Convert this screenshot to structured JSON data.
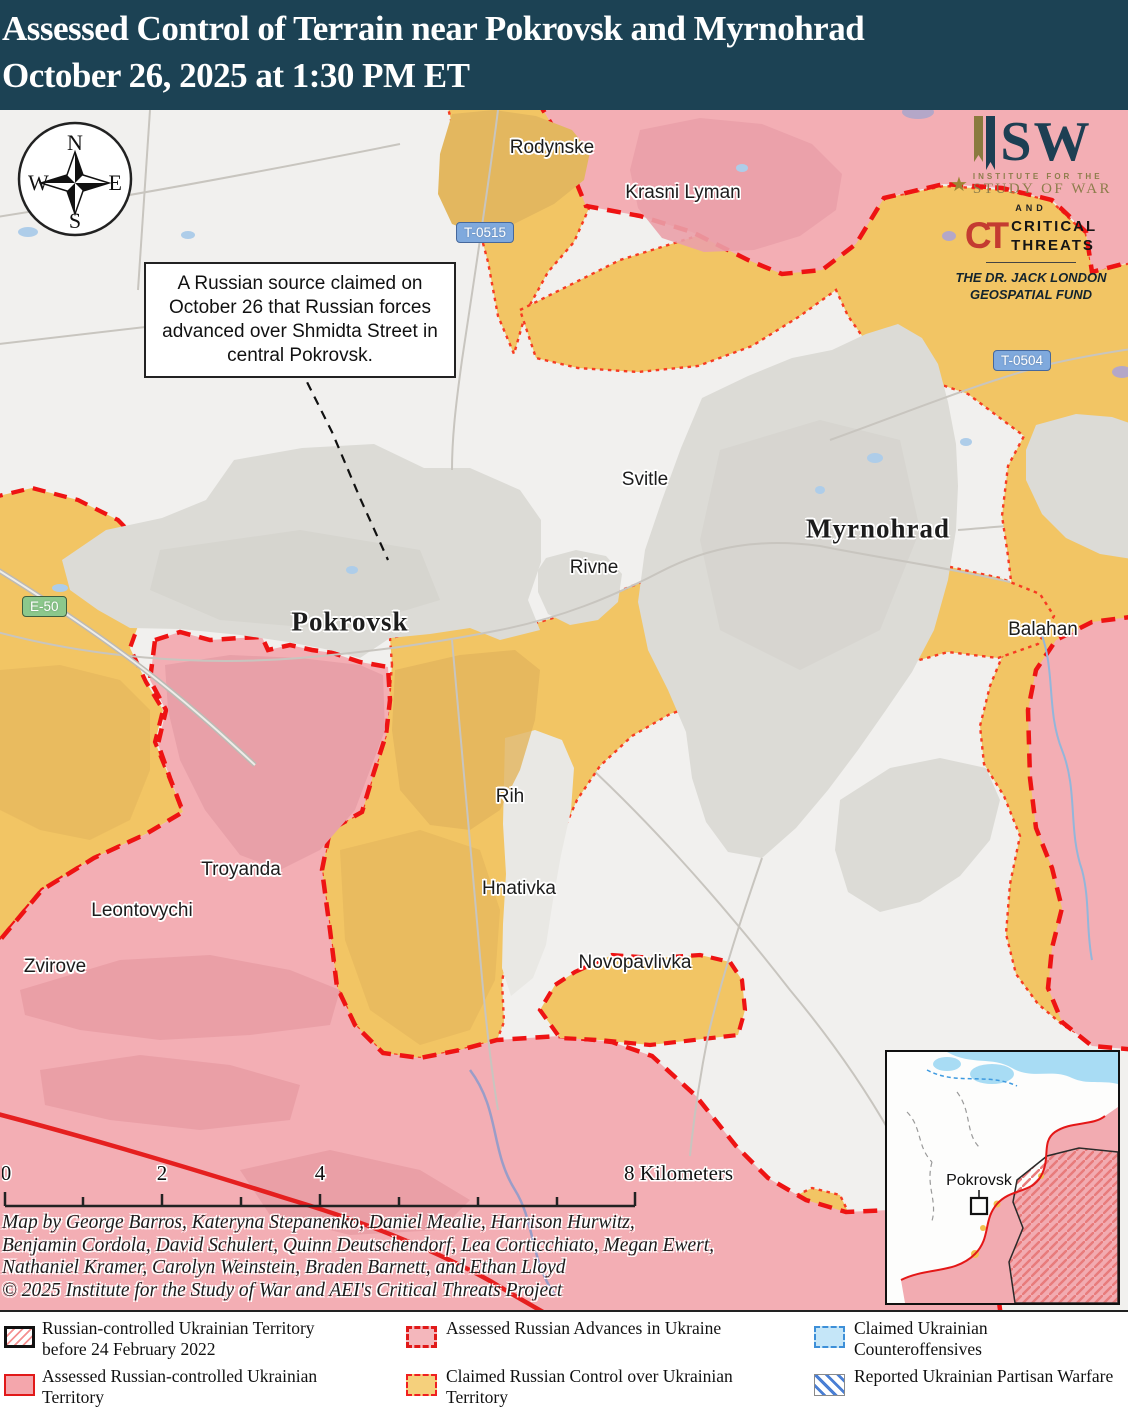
{
  "header": {
    "line1": "Assessed Control of Terrain near Pokrovsk and Myrnohrad",
    "line2": "October 26, 2025 at 1:30 PM ET"
  },
  "compass": {
    "n": "N",
    "e": "E",
    "s": "S",
    "w": "W"
  },
  "callout": {
    "text": "A Russian source claimed on October 26 that Russian forces advanced over Shmidta Street in central Pokrovsk."
  },
  "logo": {
    "isw_rest": "SW",
    "inst_line1": "INSTITUTE FOR THE",
    "inst_line2": "STUDY OF WAR",
    "and_label": "AND",
    "ct_mono": "CT",
    "ct_line1": "CRITICAL",
    "ct_line2": "THREATS",
    "fund_line1": "THE DR. JACK LONDON",
    "fund_line2": "GEOSPATIAL FUND"
  },
  "roads": {
    "t0515": "T-0515",
    "t0504": "T-0504",
    "e50": "E-50"
  },
  "places": [
    "Rodynske",
    "Krasni Lyman",
    "Svitle",
    "Rivne",
    "Balahan",
    "Rih",
    "Hnativka",
    "Novopavlivka",
    "Troyanda",
    "Leontovychi",
    "Zvirove"
  ],
  "city_labels": [
    "Pokrovsk",
    "Myrnohrad"
  ],
  "scalebar": {
    "t0": "0",
    "t2": "2",
    "t4": "4",
    "t8": "8 Kilometers"
  },
  "credits": [
    "Map by George Barros, Kateryna Stepanenko, Daniel Mealie, Harrison Hurwitz,",
    "Benjamin Cordola, David Schulert, Quinn Deutschendorf, Lea Corticchiato, Megan Ewert,",
    "Nathaniel Kramer, Carolyn Weinstein, Braden Barnett, and Ethan Lloyd",
    "© 2025 Institute for the Study of War and AEI's Critical Threats Project"
  ],
  "inset": {
    "place": "Pokrovsk"
  },
  "legend": [
    "Russian-controlled Ukrainian Territory before 24 February 2022",
    "Assessed Russian-controlled Ukrainian Territory",
    "Assessed Russian Advances in Ukraine",
    "Claimed Russian Control over Ukrainian Territory",
    "Claimed Ukrainian Counteroffensives",
    "Reported Ukrainian Partisan Warfare"
  ],
  "colors": {
    "header_bg": "#1c4254",
    "assessed_russian_fill": "#f3aeb4",
    "claimed_russian_fill": "#f2c564",
    "advance_dash_red": "#ee1313",
    "claimed_dot_red": "#f63b22",
    "counteroffensive_blue": "#c5e6f8",
    "partisan_stripe_blue": "#4a7fd4",
    "urban_gray": "#dcdbd6",
    "water_blue": "#aecde9"
  }
}
